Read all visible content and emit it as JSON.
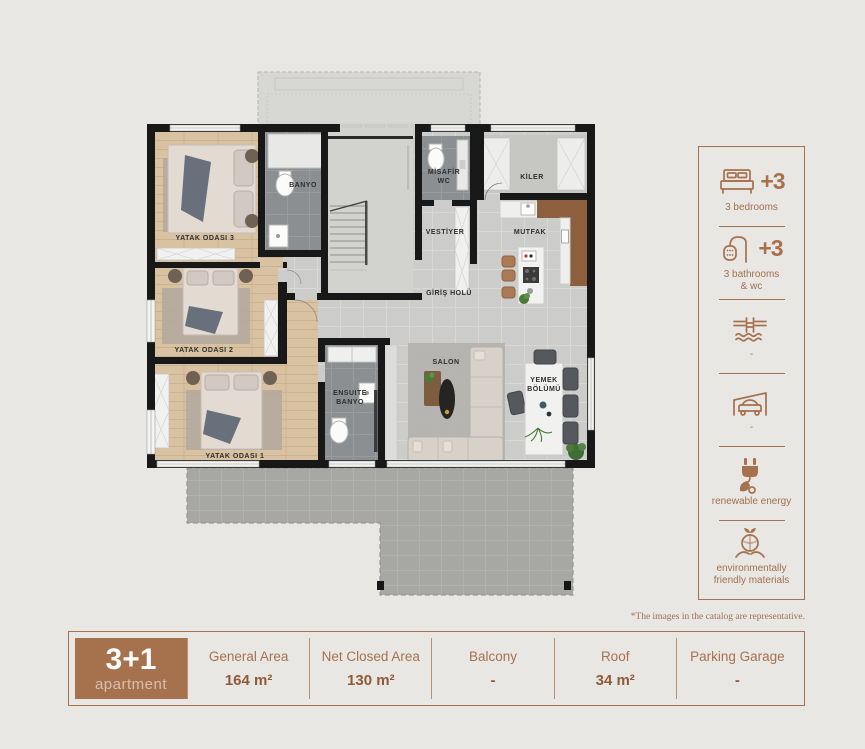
{
  "page": {
    "background": "#e9e7e4",
    "accent": "#a6714d",
    "footnote": "*The images in the catalog are representative."
  },
  "floor_plan": {
    "rooms": {
      "bedroom3": "YATAK ODASI 3",
      "bedroom2": "YATAK ODASI 2",
      "bedroom1": "YATAK ODASI 1",
      "bathroom": "BANYO",
      "guest_wc_line1": "MİSAFİR",
      "guest_wc_line2": "WC",
      "pantry": "KİLER",
      "cloakroom": "VESTİYER",
      "kitchen": "MUTFAK",
      "entrance_hall": "GİRİŞ HOLÜ",
      "living_room": "SALON",
      "dining_line1": "YEMEK",
      "dining_line2": "BÖLÜMÜ",
      "ensuite_line1": "ENSUITE",
      "ensuite_line2": "BANYO"
    }
  },
  "amenities": {
    "items": [
      {
        "icon": "bed-icon",
        "badge": "+3",
        "label_lines": [
          "3 bedrooms",
          ""
        ]
      },
      {
        "icon": "shower-icon",
        "badge": "+3",
        "label_lines": [
          "3 bathrooms",
          "& wc"
        ]
      },
      {
        "icon": "pool-icon",
        "badge": "",
        "label_lines": [
          "-",
          ""
        ]
      },
      {
        "icon": "garage-icon",
        "badge": "",
        "label_lines": [
          "-",
          ""
        ]
      },
      {
        "icon": "plug-leaf-icon",
        "badge": "",
        "label_lines": [
          "renewable energy",
          ""
        ]
      },
      {
        "icon": "eco-materials-icon",
        "badge": "",
        "label_lines": [
          "environmentally",
          "friendly materials"
        ]
      }
    ]
  },
  "summary_bar": {
    "unit_type": "3+1",
    "unit_label": "apartment",
    "cells": [
      {
        "label": "General Area",
        "value": "164 m²"
      },
      {
        "label": "Net Closed Area",
        "value": "130 m²"
      },
      {
        "label": "Balcony",
        "value": "-"
      },
      {
        "label": "Roof",
        "value": "34 m²"
      },
      {
        "label": "Parking Garage",
        "value": "-"
      }
    ]
  }
}
